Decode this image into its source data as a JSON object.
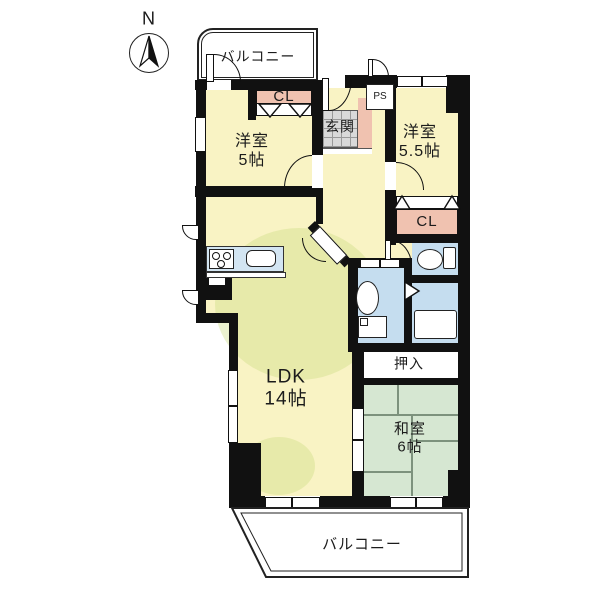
{
  "compass": {
    "label": "N"
  },
  "balconies": {
    "top": "バルコニー",
    "bottom": "バルコニー"
  },
  "rooms": {
    "western5": {
      "name": "洋室",
      "size": "5帖"
    },
    "western55": {
      "name": "洋室",
      "size": "5.5帖"
    },
    "ldk": {
      "name": "LDK",
      "size": "14帖"
    },
    "japanese6": {
      "name": "和室",
      "size": "6帖"
    },
    "entrance": {
      "name": "玄関"
    },
    "oshiire": {
      "name": "押入"
    },
    "closet_top": {
      "name": "CL"
    },
    "closet_east": {
      "name": "CL"
    },
    "pipe_space": {
      "name": "PS"
    }
  },
  "colors": {
    "wall": "#111111",
    "room_yellow": "#F9F3C4",
    "room_green": "#D6E7D2",
    "room_blue": "#C5DDEF",
    "closet_pink": "#F0C2B0",
    "tile_gray": "#D9D9D9",
    "counter_blue": "#D3E5F2"
  }
}
